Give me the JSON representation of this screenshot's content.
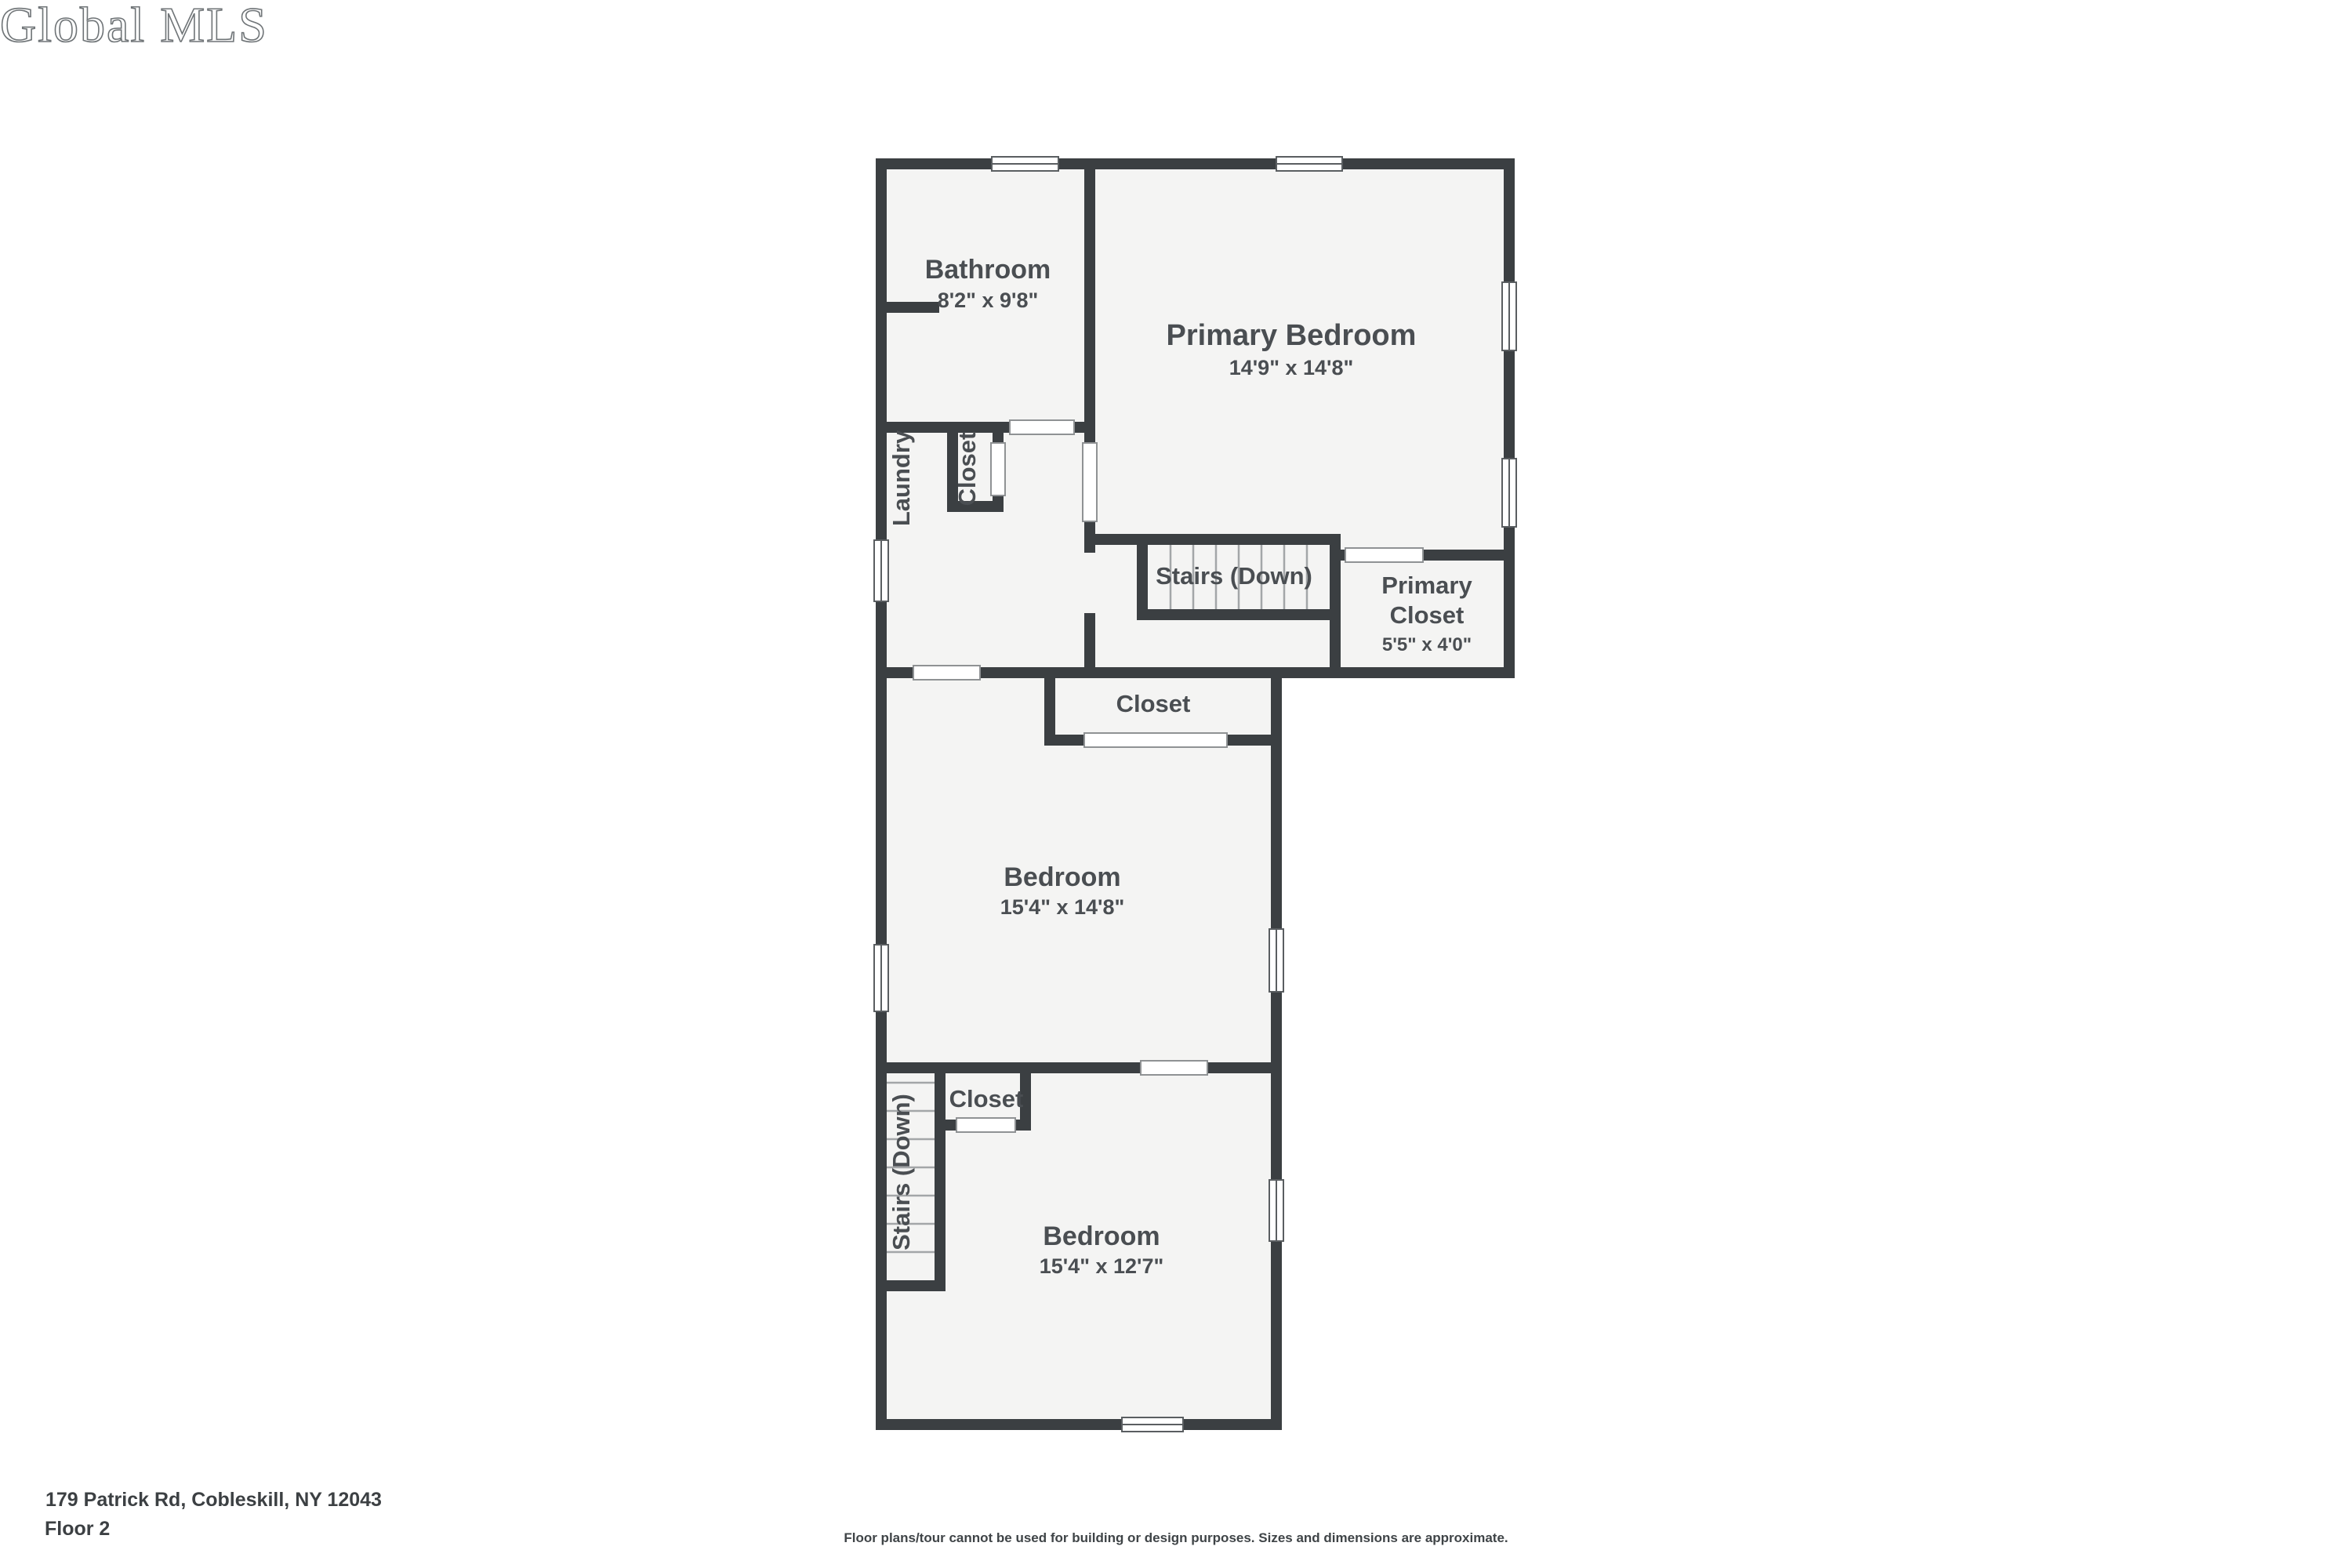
{
  "meta": {
    "watermark": "Global MLS",
    "address": "179 Patrick Rd, Cobleskill, NY 12043",
    "floor_label": "Floor 2",
    "disclaimer": "Floor plans/tour cannot be used for building or design purposes. Sizes and dimensions are approximate."
  },
  "colors": {
    "wall": "#3b3f42",
    "floor": "#f4f4f3",
    "background": "#ffffff",
    "label": "#4a4e52",
    "thin": "#8f9294"
  },
  "rooms": {
    "bathroom": {
      "name": "Bathroom",
      "dims": "8'2\" x 9'8\""
    },
    "primary_bedroom": {
      "name": "Primary Bedroom",
      "dims": "14'9\" x 14'8\""
    },
    "laundry": {
      "name": "Laundry"
    },
    "laundry_closet": {
      "name": "Closet"
    },
    "stairs_upper": {
      "name": "Stairs (Down)"
    },
    "primary_closet": {
      "name_line1": "Primary",
      "name_line2": "Closet",
      "dims": "5'5\" x 4'0\""
    },
    "hall_closet": {
      "name": "Closet"
    },
    "bedroom_middle": {
      "name": "Bedroom",
      "dims": "15'4\" x 14'8\""
    },
    "lower_closet": {
      "name": "Closet"
    },
    "stairs_lower": {
      "name": "Stairs (Down)"
    },
    "bedroom_lower": {
      "name": "Bedroom",
      "dims": "15'4\" x 12'7\""
    }
  }
}
